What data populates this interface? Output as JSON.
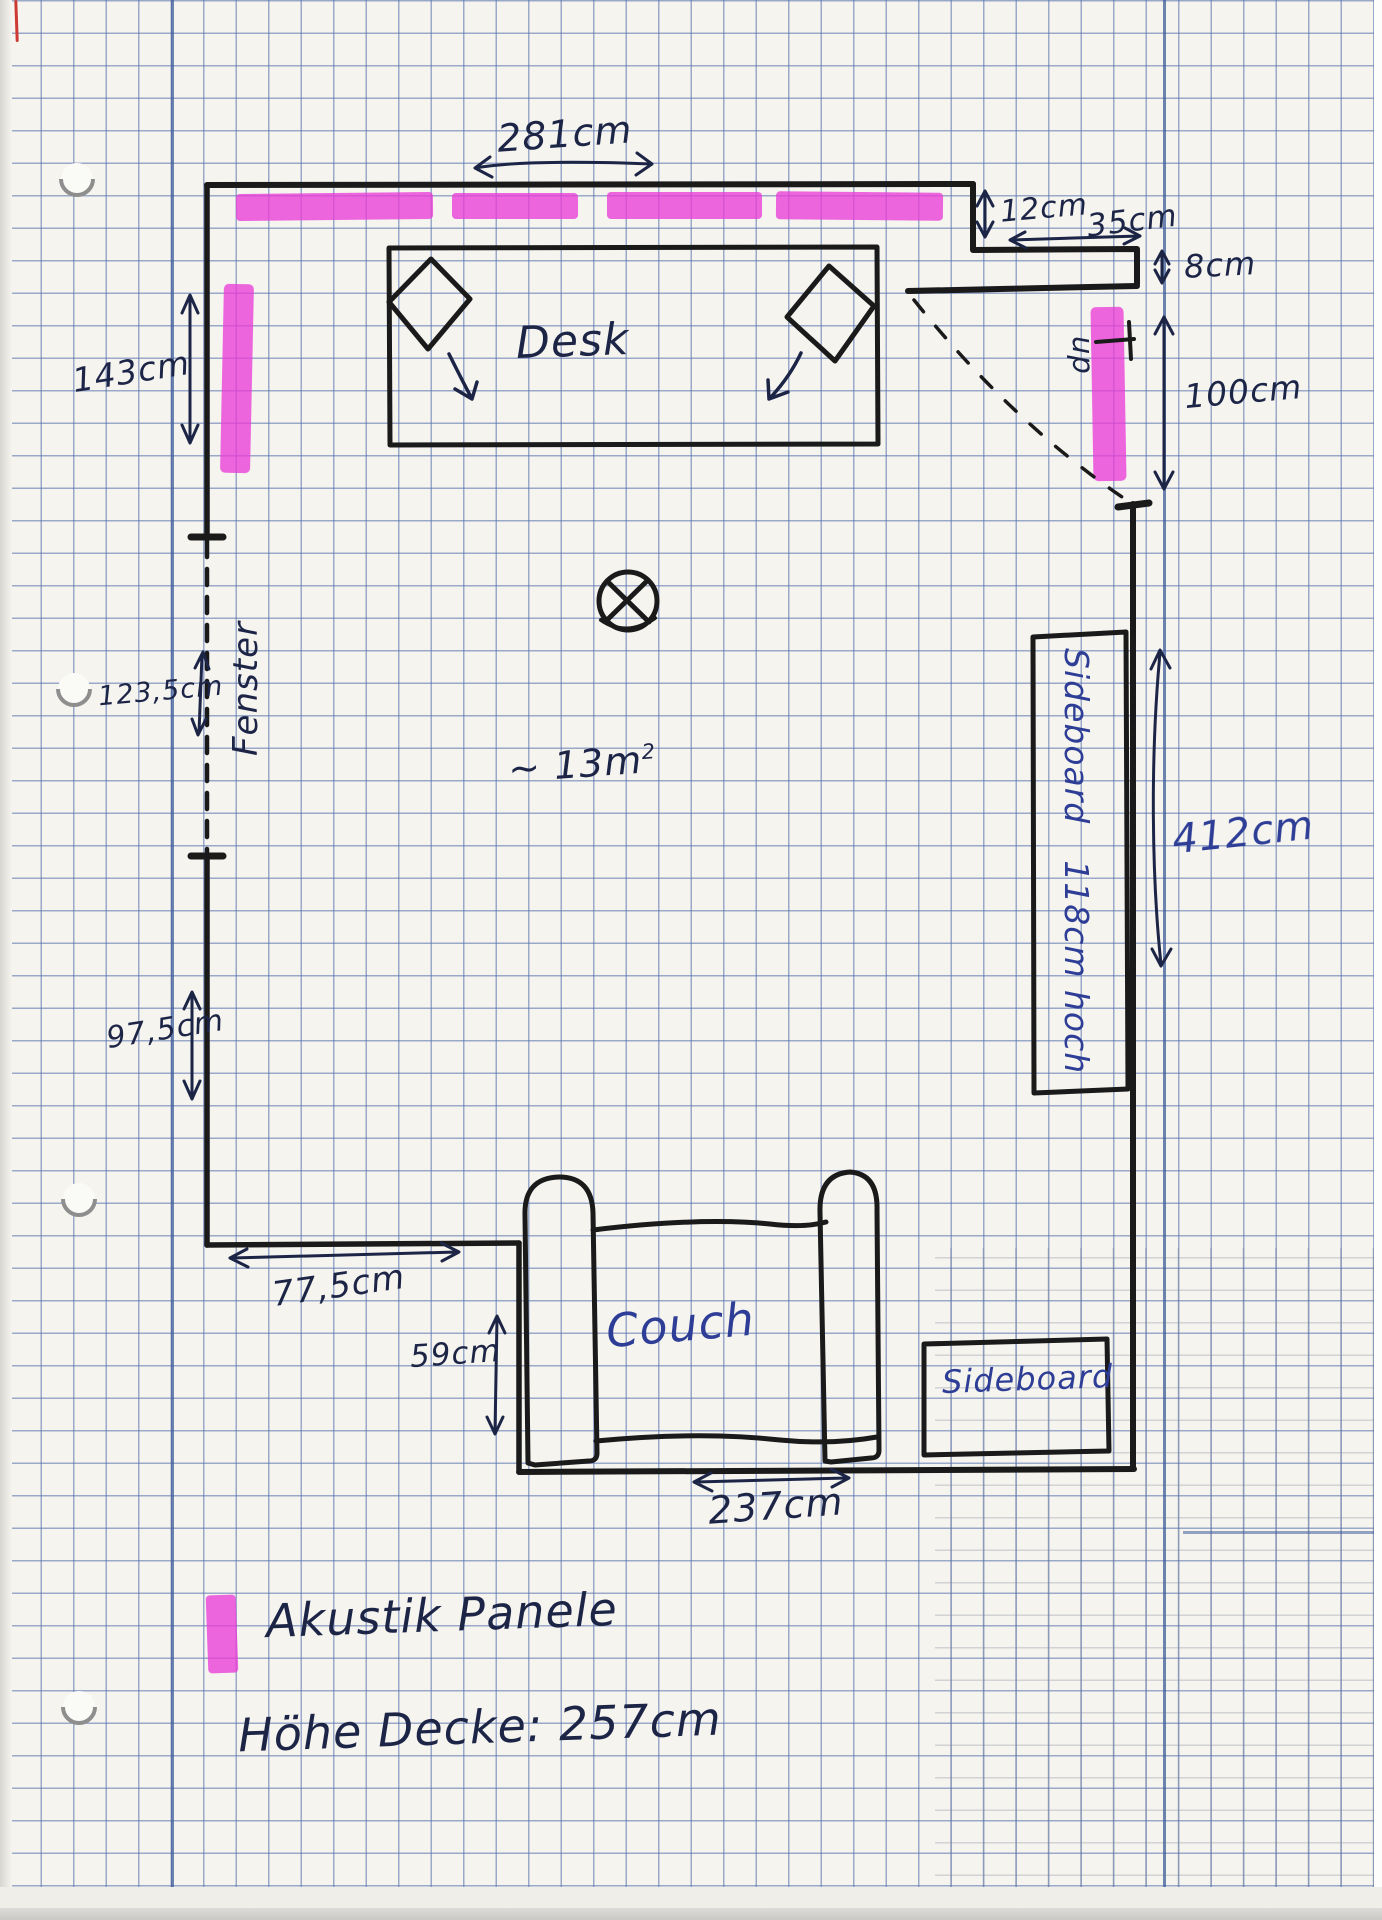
{
  "plan": {
    "room": {
      "area_base": "~ 13m",
      "area_sup": "2"
    },
    "furniture": {
      "desk": "Desk",
      "couch": "Couch",
      "sideboard_tall": "Sideboard",
      "sideboard_tall_note": "118cm hoch",
      "sideboard_small": "Sideboard"
    },
    "openings": {
      "window": "Fenster",
      "stairs_up": "up"
    },
    "measurements": {
      "top_width": "281cm",
      "notch_depth": "12cm",
      "notch_width": "35cm",
      "ledge_depth": "8cm",
      "door_opening": "100cm",
      "left_upper": "143cm",
      "window_width": "123,5cm",
      "left_lower": "97,5cm",
      "bottom_left_width": "77,5cm",
      "couch_offset": "59cm",
      "couch_width": "237cm",
      "right_wall": "412cm"
    },
    "legend": {
      "highlight_label": "Akustik Panele",
      "ceiling_height": "Höhe Decke: 257cm"
    },
    "colors": {
      "highlighter": "#e93cd8",
      "ink": "#1d2547",
      "ink_blue": "#2e3e96",
      "wall": "#1a1a1a",
      "grid": "#5d75b0",
      "paper": "#f5f4ef"
    }
  }
}
